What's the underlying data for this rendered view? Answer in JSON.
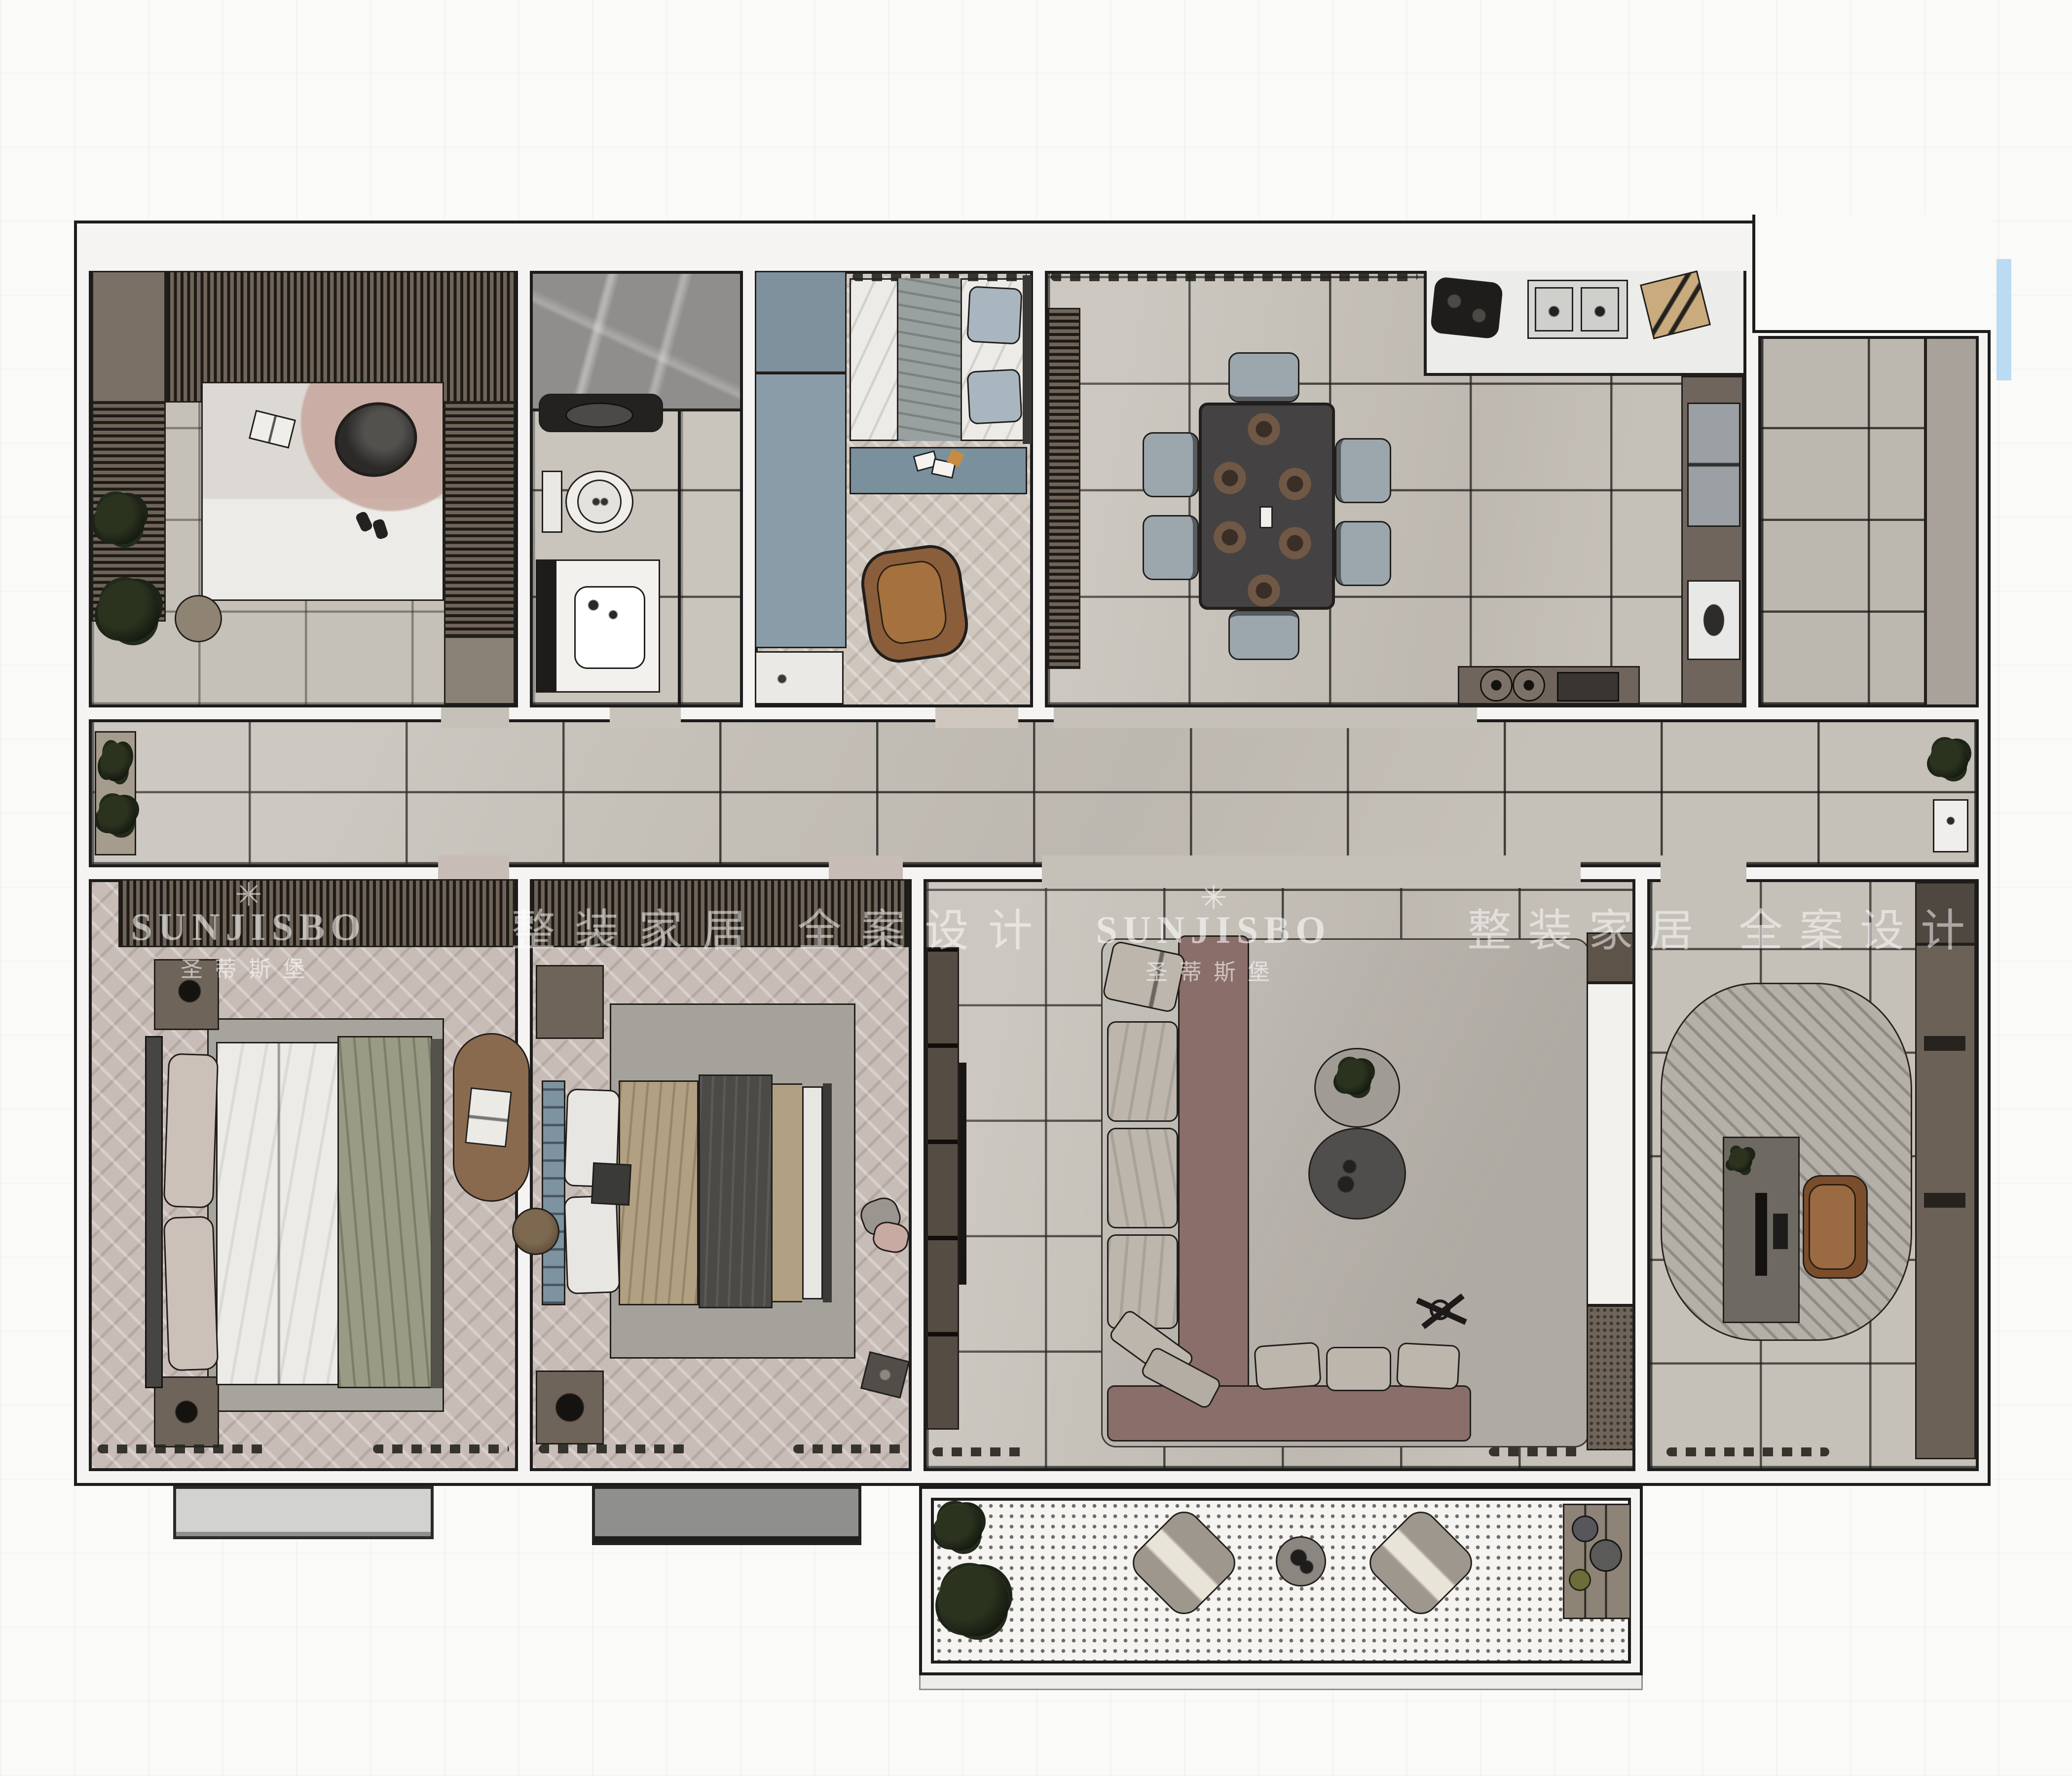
{
  "watermarks": {
    "logo_glyph": "✳",
    "brand_name": "SUNJISBO",
    "brand_name_cn": "圣蒂斯堡",
    "tagline_cn": "整装家居 全案设计"
  },
  "palette": {
    "background": "#fafaf9",
    "wall_fill": "#f5f4f2",
    "wall_outline": "#1c1c1c",
    "floor_tile": "#c5c0b8",
    "floor_herringbone": "#c8bcb7",
    "cabinet_brown": "#6f6459",
    "cabinet_blue": "#8496a2",
    "sofa_base_mauve": "#8a6e69",
    "cushion_gray": "#bcb6ad",
    "dining_table_dark": "#454243",
    "chair_bluegray": "#9ba6ad",
    "balcony_dot_floor": "#f5f4f1",
    "accent_blue_stripe": "#badbf2",
    "watermark_white": "rgba(255,255,255,0.58)"
  }
}
